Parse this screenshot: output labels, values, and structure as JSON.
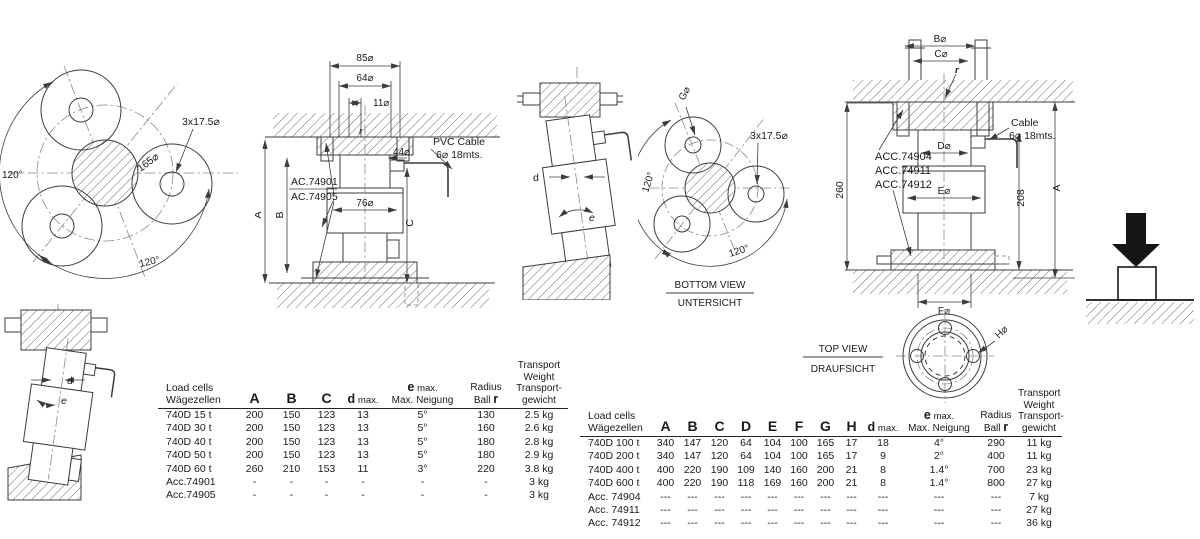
{
  "drawings": {
    "bv_left": {
      "angle_left": "120°",
      "angle_bottom": "120°",
      "bolt_circle": "165⌀",
      "holes": "3x17.5⌀"
    },
    "sec_left": {
      "dim85": "85⌀",
      "dim64": "64⌀",
      "dim11": "11⌀",
      "dim44": "44⌀",
      "dim76": "76⌀",
      "dimA": "A",
      "dimB": "B",
      "dimC": "C",
      "r": "r",
      "cable1": "PVC Cable",
      "cable2": "6⌀ 18mts.",
      "acc1": "AC.74901",
      "acc2": "AC.74905"
    },
    "tilt_mid": {
      "d": "d",
      "e": "e"
    },
    "bv_mid": {
      "g": "G⌀",
      "holes": "3x17.5⌀",
      "angle_left": "120°",
      "angle_bottom": "120°",
      "title_en": "BOTTOM VIEW",
      "title_de": "UNTERSICHT"
    },
    "sec_right": {
      "dimB": "B⌀",
      "dimC": "C⌀",
      "dimD": "D⌀",
      "dimE": "E⌀",
      "dimF": "F⌀",
      "r": "r",
      "cable1": "Cable",
      "cable2": "6⌀ 18mts.",
      "acc1": "ACC.74904",
      "acc2": "ACC.74911",
      "acc3": "ACC.74912",
      "dim260": "260",
      "dim208": "208",
      "dimA": "A"
    },
    "top_view": {
      "title_en": "TOP VIEW",
      "title_de": "DRAUFSICHT",
      "h": "H⌀"
    },
    "tilt_bl": {
      "d": "d",
      "e": "e"
    }
  },
  "tables": {
    "left": {
      "header": {
        "name1": "Load cells",
        "name2": "Wägezellen",
        "a": "A",
        "b": "B",
        "c": "C",
        "d_bold": "d",
        "d_small": "max.",
        "e_bold": "e",
        "e_small": "max.",
        "e_line2": "Max. Neigung",
        "radius1": "Radius",
        "radius2": "Ball",
        "radius2_bold": "r",
        "w1": "Transport",
        "w2": "Weight",
        "w3": "Transport-",
        "w4": "gewicht"
      },
      "rows": [
        [
          "740D 15 t",
          "200",
          "150",
          "123",
          "13",
          "5°",
          "130",
          "2.5 kg"
        ],
        [
          "740D 30 t",
          "200",
          "150",
          "123",
          "13",
          "5°",
          "160",
          "2.6 kg"
        ],
        [
          "740D 40 t",
          "200",
          "150",
          "123",
          "13",
          "5°",
          "180",
          "2.8 kg"
        ],
        [
          "740D 50 t",
          "200",
          "150",
          "123",
          "13",
          "5°",
          "180",
          "2.9 kg"
        ],
        [
          "740D 60 t",
          "260",
          "210",
          "153",
          "11",
          "3°",
          "220",
          "3.8 kg"
        ],
        [
          "Acc.74901",
          "-",
          "-",
          "-",
          "-",
          "-",
          "-",
          "3 kg"
        ],
        [
          "Acc.74905",
          "-",
          "-",
          "-",
          "-",
          "-",
          "-",
          "3 kg"
        ]
      ]
    },
    "right": {
      "header": {
        "name1": "Load cells",
        "name2": "Wägezellen",
        "a": "A",
        "b": "B",
        "c": "C",
        "d": "D",
        "e": "E",
        "f": "F",
        "g": "G",
        "h": "H",
        "d_bold": "d",
        "d_small": "max.",
        "e_bold": "e",
        "e_small": "max.",
        "e_line2": "Max. Neigung",
        "radius1": "Radius",
        "radius2": "Ball",
        "radius2_bold": "r",
        "w1": "Transport",
        "w2": "Weight",
        "w3": "Transport-",
        "w4": "gewicht"
      },
      "rows": [
        [
          "740D 100 t",
          "340",
          "147",
          "120",
          "64",
          "104",
          "100",
          "165",
          "17",
          "18",
          "4°",
          "290",
          "11 kg"
        ],
        [
          "740D 200 t",
          "340",
          "147",
          "120",
          "64",
          "104",
          "100",
          "165",
          "17",
          "9",
          "2°",
          "400",
          "11 kg"
        ],
        [
          "740D 400 t",
          "400",
          "220",
          "190",
          "109",
          "140",
          "160",
          "200",
          "21",
          "8",
          "1.4°",
          "700",
          "23 kg"
        ],
        [
          "740D 600 t",
          "400",
          "220",
          "190",
          "118",
          "169",
          "160",
          "200",
          "21",
          "8",
          "1.4°",
          "800",
          "27 kg"
        ],
        [
          "Acc. 74904",
          "---",
          "---",
          "---",
          "---",
          "---",
          "---",
          "---",
          "---",
          "---",
          "---",
          "---",
          "7 kg"
        ],
        [
          "Acc. 74911",
          "---",
          "---",
          "---",
          "---",
          "---",
          "---",
          "---",
          "---",
          "---",
          "---",
          "---",
          "27 kg"
        ],
        [
          "Acc. 74912",
          "---",
          "---",
          "---",
          "---",
          "---",
          "---",
          "---",
          "---",
          "---",
          "---",
          "---",
          "36 kg"
        ]
      ]
    }
  }
}
